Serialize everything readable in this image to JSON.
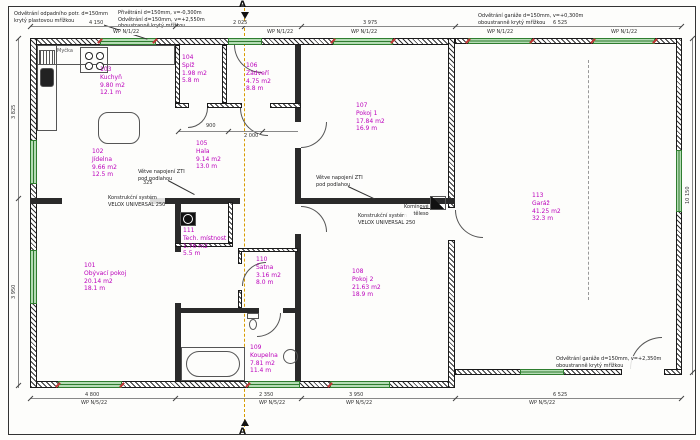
{
  "drawing": {
    "section_marker": "A",
    "colors": {
      "room_label": "#bb00bb",
      "window_fill": "#b5dcb5",
      "window_border": "#2f7d2f",
      "axis": "#d89c00",
      "red_mark": "#c03636",
      "wall": "#1a1a1a"
    }
  },
  "notes": {
    "top_left": [
      "Odvětrání odpadního potr. d=150mm",
      "krytý plastovou mřížkou"
    ],
    "top_mid": [
      "Přivětrání d=150mm, v=-0,300m",
      "Odvětrání d=150mm, v=+2,550m",
      "oboustranně krytý mřížkou"
    ],
    "top_right": [
      "Odvětrání garáže d=150mm, v=+0,300m",
      "oboustranně krytý mřížkou"
    ],
    "bottom_right": [
      "Odvětrání garáže d=150mm, v=+2,350m",
      "oboustranně krytý mřížkou"
    ],
    "zti_left": [
      "Větve napojení ZTI",
      "pod podlahou"
    ],
    "zti_right": [
      "Větve napojení ZTI",
      "pod podlahou"
    ],
    "velox_left": [
      "Konstrukční systém",
      "VELOX UNIVERSAL 250"
    ],
    "velox_right": [
      "Konstrukční systém",
      "VELOX UNIVERSAL 250"
    ],
    "chimney": [
      "Komínové",
      "těleso"
    ],
    "dishwasher": "Myčka"
  },
  "window_marks": {
    "top": "WP N/1/22",
    "bottom": "WP N/5/22"
  },
  "rooms": [
    {
      "id": "101",
      "name": "Obývací pokoj",
      "area": "20.14 m2",
      "perimeter": "18.1 m"
    },
    {
      "id": "102",
      "name": "Jídelna",
      "area": "9.66 m2",
      "perimeter": "12.5 m"
    },
    {
      "id": "103",
      "name": "Kuchyň",
      "area": "9.80 m2",
      "perimeter": "12.1 m"
    },
    {
      "id": "104",
      "name": "Spíž",
      "area": "1.98 m2",
      "perimeter": "5.8 m"
    },
    {
      "id": "105",
      "name": "Hala",
      "area": "9.14 m2",
      "perimeter": "13.0 m"
    },
    {
      "id": "106",
      "name": "Zádveří",
      "area": "4.75 m2",
      "perimeter": "8.8 m"
    },
    {
      "id": "107",
      "name": "Pokoj 1",
      "area": "17.84 m2",
      "perimeter": "16.9 m"
    },
    {
      "id": "108",
      "name": "Pokoj 2",
      "area": "21.63 m2",
      "perimeter": "18.9 m"
    },
    {
      "id": "109",
      "name": "Koupelna",
      "area": "7.81 m2",
      "perimeter": "11.4 m"
    },
    {
      "id": "110",
      "name": "Šatna",
      "area": "3.16 m2",
      "perimeter": "8.0 m"
    },
    {
      "id": "111",
      "name": "Tech. místnost",
      "area": "1.76 m2",
      "perimeter": "5.5 m"
    },
    {
      "id": "113",
      "name": "Garáž",
      "area": "41.25 m2",
      "perimeter": "32.3 m"
    }
  ],
  "dimensions": {
    "top": [
      "4 150",
      "2 025",
      "3 975",
      "6 525"
    ],
    "bottom": [
      "4 800",
      "2 350",
      "3 950",
      "6 525"
    ],
    "left": [
      "3 825",
      "3 950"
    ],
    "right": [
      "10 150"
    ],
    "inner": [
      "900",
      "2 000",
      "325"
    ]
  }
}
